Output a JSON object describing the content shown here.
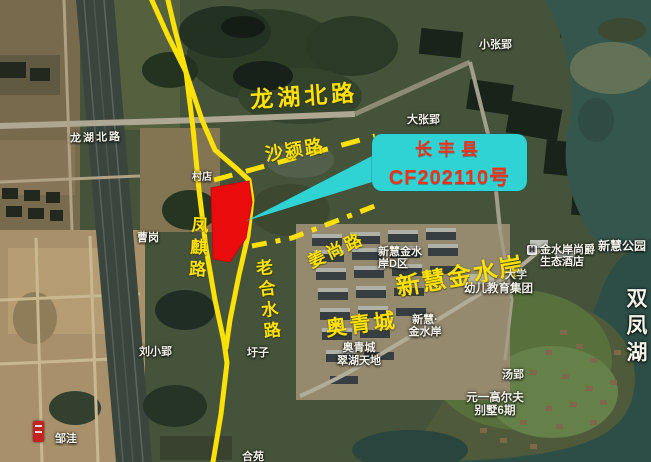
{
  "map": {
    "type": "satellite-parcel-announcement",
    "callout": {
      "line1": "长丰县",
      "line2": "CF202110号",
      "box_color": "#2fd3d4",
      "text_color": "#f23018"
    },
    "parcel": {
      "color": "#ea0c0c"
    },
    "annotation_color": "#ffe103",
    "road_labels": {
      "longhu_north_road_big": "龙湖北路",
      "shaying_road": "沙颍路",
      "fengqi_road": "凤麒路",
      "laohe_shui_road": "老合水路",
      "jiangshang_road": "姜尚路",
      "aoqingcheng_big": "奥青城",
      "xinhui_jinshuian_big": "新慧金水岸"
    },
    "poi_labels": {
      "longhu_north_road_small": "龙湖北路",
      "xiaozhangying": "小张郢",
      "dazhangying": "大张郢",
      "cundian": "村店",
      "caogang": "曹岗",
      "liuxiaoying": "刘小郢",
      "weizi": "圩子",
      "zouwa": "邹洼",
      "heyuan": "合苑",
      "xinhui_jinshui_d_line1": "新慧金水",
      "xinhui_jinshui_d_line2": "岸D区",
      "daxue": "大学",
      "hotel_icon": "H",
      "hotel_line1": "金水岸尚爵",
      "hotel_line2": "生态酒店",
      "xinhui_park": "新慧公园",
      "xinhui_small_line1": "新慧·",
      "xinhui_small_line2": "金水岸",
      "aoqingcheng_small_line1": "奥青城",
      "aoqingcheng_small_line2": "翠湖天地",
      "kindergarten": "幼儿教育集团",
      "tangying": "汤郢",
      "golf_line1": "元一高尔夫",
      "golf_line2": "别墅6期",
      "shuangfenghu_lake": "双凤湖"
    }
  }
}
